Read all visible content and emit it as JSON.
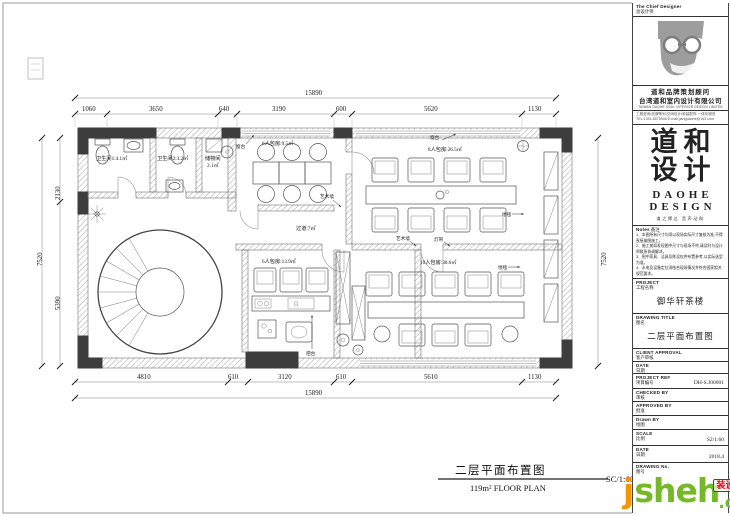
{
  "plan": {
    "dims_top_total": "15890",
    "dims_top": [
      "1060",
      "3650",
      "640",
      "3190",
      "600",
      "5620",
      "1130"
    ],
    "dims_bottom": [
      "4810",
      "610",
      "3120",
      "610",
      "5610",
      "1130"
    ],
    "dims_bottom_total": "15890",
    "dims_left": [
      "2130",
      "5390"
    ],
    "dims_left_total": "7520",
    "dims_right_total": "7520",
    "rooms": {
      "bath1": "卫生间1:4.1㎡",
      "bath2": "卫生间2:3.2㎡",
      "store_name": "储物间",
      "store_area": "2.1㎡",
      "room6a": "6人包房:9.5㎡",
      "room8": "8人包房:26.5㎡",
      "corridor": "过道:7㎡",
      "room6b": "6人包房:13.9㎡",
      "room10": "10人包房:30.6㎡"
    },
    "callouts": {
      "sill": "窗台",
      "art_wall": "艺术墙",
      "carpet": "地毯",
      "bar": "吧台",
      "light_band": "灯带"
    },
    "bottom_title": {
      "cn": "二层平面布置图",
      "sub": "119m²   FLOOR PLAN",
      "scale": "SC/1:60"
    }
  },
  "titleblock": {
    "chief_en": "The Chief Designer",
    "chief_cn": "总设计师",
    "company_cn1": "道和品牌策划顾问",
    "company_cn2": "台湾道和室内设计有限公司",
    "company_en": "TAIWAN DAOHE SOUL INTERIOR DESIGN LIMITED",
    "micro1": "工程咨询/品牌策划/空间设计/软装配饰 一体化服务",
    "micro2": "TEL:1391-8575508  E-mail:jiangdaohe@163.com",
    "brand_row1": "道和",
    "brand_row2": "设计",
    "brand_en1": "DAOHE",
    "brand_en2": "DESIGN",
    "tagline": "道之博达  音声动和",
    "notes_en": "Notes",
    "notes_cn": "备注",
    "notes": [
      "1、本图所有尺寸均须以现场实际尺寸复核为准,不得直接量图施工。",
      "2、施工前如发现图中尺寸与现场不符,请及时与设计师联系协调解决。",
      "3、图中家具、洁具及陈设仅供布置参考,以实际选型为准。",
      "4、水电及设备定位须结合现场情况并符合国家相关规范要求。"
    ],
    "project_en": "PROJECT",
    "project_cn": "工程名称",
    "project_value": "御华轩茶楼",
    "drawing_title_en": "DRAWING TITLE",
    "drawing_title_cn": "图名",
    "drawing_title_value": "二层平面布置图",
    "client_approval_en": "CLIENT APPROVAL",
    "client_approval_cn": "客户审核",
    "date1_en": "DATE",
    "date1_cn": "日期",
    "project_ref_en": "PROJECT REF",
    "project_ref_cn": "项目编号",
    "project_ref_value": "DH-S.J00001",
    "checked_en": "CHECKED BY",
    "checked_cn": "审核",
    "approved_en": "APPROVED BY",
    "approved_cn": "批准",
    "drawn_en": "Drawn BY",
    "drawn_cn": "绘图",
    "scale_en": "SCALE",
    "scale_cn": "比例",
    "scale_value": "S2/1:60",
    "date2_en": "DATE",
    "date2_cn": "日期",
    "date2_value": "2018.4",
    "drawing_no_en": "DRAWING No.",
    "drawing_no_cn": "图号"
  },
  "watermark": {
    "j": "j",
    "rest": "sheh",
    "stamp": "装设汇",
    "com": ".com"
  }
}
